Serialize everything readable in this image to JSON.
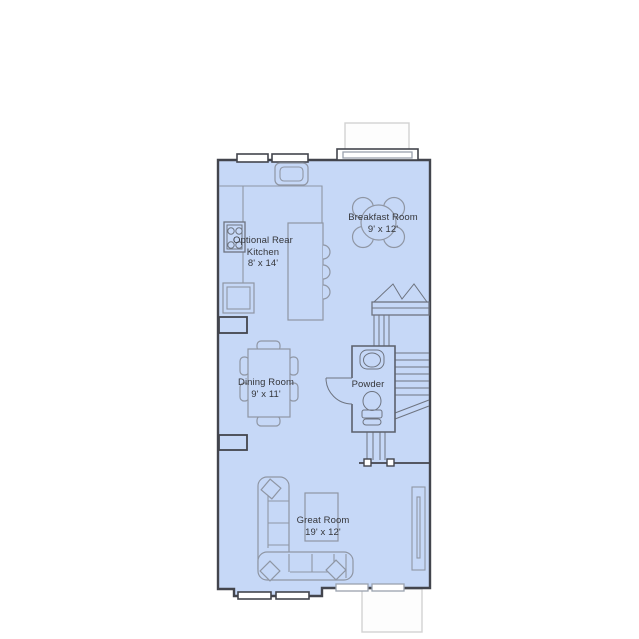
{
  "palette": {
    "floor": "#c6d8f7",
    "wall": "#43454d",
    "furn": "#8f96a4",
    "fix": "#6e7480",
    "extline": "#d2d2d2",
    "text": "#35363a"
  },
  "rooms": {
    "breakfast": {
      "name": "Breakfast Room",
      "dims": "9' x 12'"
    },
    "kitchen": {
      "name": "Optional Rear Kitchen",
      "dims": "8' x 14'"
    },
    "dining": {
      "name": "Dining Room",
      "dims": "9' x 11'"
    },
    "powder": {
      "name": "Powder"
    },
    "great": {
      "name": "Great Room",
      "dims": "19' x 12'"
    }
  },
  "fixtures": [
    "bay-window",
    "entry-porch",
    "range",
    "cooktop",
    "refrigerator",
    "kitchen-island",
    "island-stools",
    "breakfast-table",
    "dining-table",
    "staircase",
    "powder-sink",
    "toilet",
    "sectional-sofa",
    "coffee-table",
    "media-unit",
    "windows"
  ]
}
